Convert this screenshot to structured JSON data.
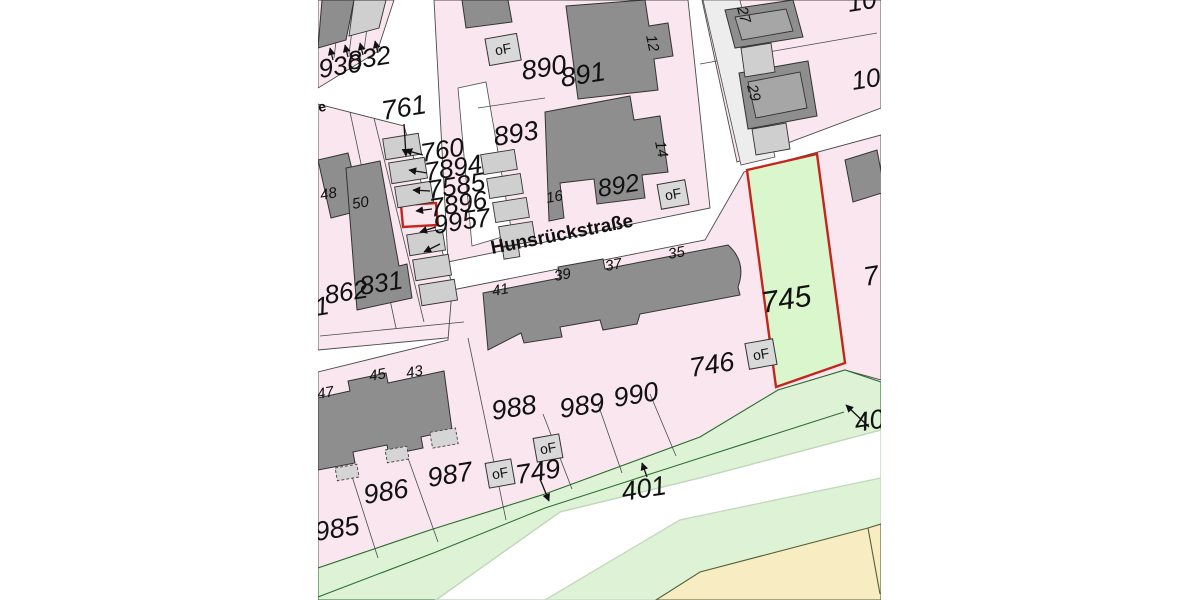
{
  "map": {
    "type": "cadastral-parcel-map",
    "street": {
      "name": "Hunsrückstraße",
      "left_edge_fragment": "e"
    },
    "of_label": "oF",
    "highlight": {
      "green_parcel_label": "745",
      "red_outline_color": "#c4251d",
      "small_red_rectangle_present": true
    },
    "parcels": {
      "p930": "930",
      "p832": "832",
      "p761": "761",
      "p760": "760",
      "p7894": "7894",
      "p7585": "7585",
      "p7896": "7896",
      "p995": "995",
      "p7a": "7",
      "p890": "890",
      "p891": "891",
      "p893": "893",
      "p892": "892",
      "p862": "862",
      "p831": "831",
      "p1cut": "1",
      "p745": "745",
      "p746": "746",
      "p749": "749",
      "p988": "988",
      "p989": "989",
      "p990": "990",
      "p985": "985",
      "p986": "986",
      "p987": "987",
      "p401": "401",
      "p40cut": "40",
      "p7b": "7",
      "p10a": "10",
      "p10b": "10"
    },
    "house_numbers": {
      "h12": "12",
      "h14": "14",
      "h16": "16",
      "h27": "27",
      "h29": "29",
      "h35": "35",
      "h37": "37",
      "h39": "39",
      "h41": "41",
      "h43": "43",
      "h45": "45",
      "h47": "47",
      "h48": "48",
      "h50": "50"
    },
    "colors": {
      "parcel_fill": "#f9e6ee",
      "building_fill": "#8e8e8e",
      "garage_fill": "#cfcfcf",
      "highlight_fill": "#d9f6cd",
      "highlight_stroke": "#c4251d",
      "green_area_fill": "#def3d6",
      "green_boundary_line": "#2e7031",
      "road_fill": "#ffffff",
      "farmland_fill": "#f8ecc3",
      "boundary_line": "#4b4b4b",
      "label_text": "#111111"
    }
  }
}
